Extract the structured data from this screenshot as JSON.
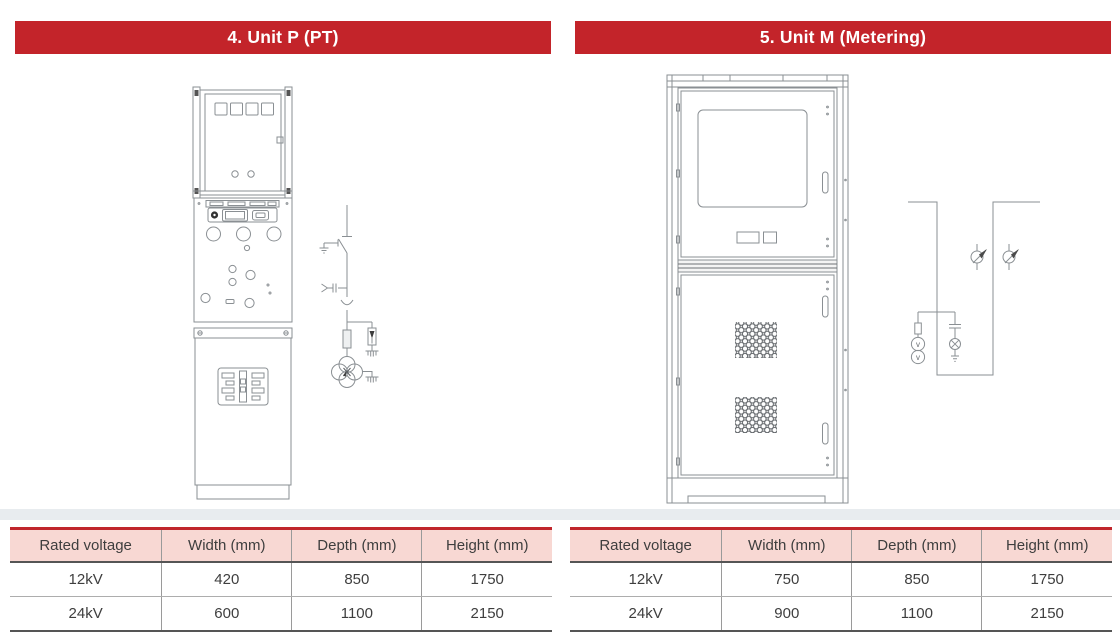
{
  "panels": [
    {
      "id": "unit-p",
      "title": "4. Unit P (PT)",
      "table": {
        "headers": [
          "Rated voltage",
          "Width (mm)",
          "Depth (mm)",
          "Height (mm)"
        ],
        "rows": [
          [
            "12kV",
            "420",
            "850",
            "1750"
          ],
          [
            "24kV",
            "600",
            "1100",
            "2150"
          ]
        ]
      }
    },
    {
      "id": "unit-m",
      "title": "5. Unit M (Metering)",
      "vt_label": "v",
      "table": {
        "headers": [
          "Rated voltage",
          "Width (mm)",
          "Depth (mm)",
          "Height (mm)"
        ],
        "rows": [
          [
            "12kV",
            "750",
            "850",
            "1750"
          ],
          [
            "24kV",
            "900",
            "1100",
            "2150"
          ]
        ]
      }
    }
  ],
  "colors": {
    "banner_red": "#c3242a",
    "table_header_pink": "#f8d8d3",
    "table_top_border_red": "#c0262c",
    "text_dark": "#3e3e3e",
    "drawing_line_gray": "#8a8f93"
  }
}
